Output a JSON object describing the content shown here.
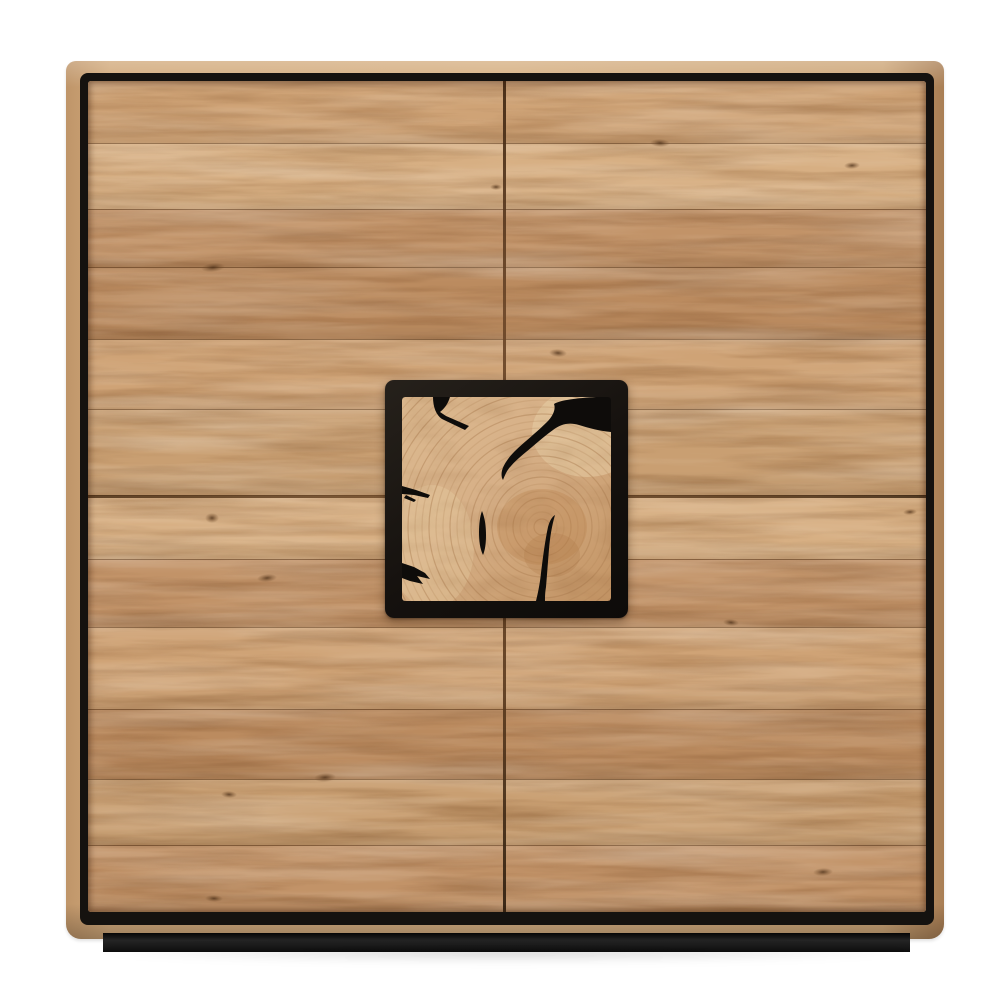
{
  "scene": {
    "type": "product-photo",
    "subject": "oak-highboard-cabinet",
    "description": "Front view of a square solid-oak cabinet with four flush plank doors, a recessed black trim frame around the door field, a recessed black plinth base, and a central black-framed end-grain oak inlay panel with black resin-filled cracks, on a plain white background.",
    "background_color": "#ffffff"
  },
  "colors": {
    "background": "#ffffff",
    "trim-black": "#15120f",
    "plinth-black": "#181818",
    "panel-frame": "#17130f",
    "crack-black": "#0e0c0a",
    "ring-stroke": "#ad7f51",
    "wood-edge-light": "#d6b083",
    "wood-edge-dark": "#a97e54",
    "plank-t1": "#cfa376",
    "plank-t2": "#c29368",
    "plank-t3": "#d7af83",
    "plank-t4": "#bb8b5f",
    "plank-t5": "#c99f72",
    "plank-seam": "#5e3c1e",
    "knot-brown": "#5f4124",
    "endgrain-light": "#e5cba1",
    "endgrain-base": "#d7b087",
    "endgrain-dark": "#c08e5c"
  },
  "cabinet": {
    "doors": {
      "rows": 2,
      "cols": 2,
      "handles": "none"
    },
    "planks": [
      {
        "height": 62,
        "tone": "plank-t1"
      },
      {
        "height": 66,
        "tone": "plank-t3"
      },
      {
        "height": 58,
        "tone": "plank-t2"
      },
      {
        "height": 72,
        "tone": "plank-t4"
      },
      {
        "height": 70,
        "tone": "plank-t1"
      },
      {
        "height": 86,
        "tone": "plank-t5"
      },
      {
        "height": 64,
        "tone": "plank-t3"
      },
      {
        "height": 68,
        "tone": "plank-t2"
      },
      {
        "height": 82,
        "tone": "plank-t1"
      },
      {
        "height": 70,
        "tone": "plank-t4"
      },
      {
        "height": 66,
        "tone": "plank-t5"
      },
      {
        "height": 67,
        "tone": "plank-t2"
      }
    ],
    "knots": [
      {
        "x": 125,
        "y": 186,
        "w": 24,
        "h": 9,
        "r": -6
      },
      {
        "x": 470,
        "y": 272,
        "w": 18,
        "h": 8,
        "r": 4
      },
      {
        "x": 764,
        "y": 84,
        "w": 16,
        "h": 7,
        "r": -3
      },
      {
        "x": 572,
        "y": 62,
        "w": 20,
        "h": 8,
        "r": 2
      },
      {
        "x": 408,
        "y": 106,
        "w": 12,
        "h": 6,
        "r": 0
      },
      {
        "x": 124,
        "y": 437,
        "w": 14,
        "h": 10,
        "r": 0
      },
      {
        "x": 179,
        "y": 497,
        "w": 20,
        "h": 8,
        "r": -5
      },
      {
        "x": 141,
        "y": 713,
        "w": 16,
        "h": 7,
        "r": 3
      },
      {
        "x": 237,
        "y": 696,
        "w": 22,
        "h": 9,
        "r": -4
      },
      {
        "x": 126,
        "y": 817,
        "w": 18,
        "h": 7,
        "r": 2
      },
      {
        "x": 735,
        "y": 791,
        "w": 20,
        "h": 8,
        "r": -3
      },
      {
        "x": 643,
        "y": 541,
        "w": 16,
        "h": 7,
        "r": 5
      },
      {
        "x": 822,
        "y": 431,
        "w": 14,
        "h": 6,
        "r": -4
      }
    ],
    "center_panel": {
      "rings": {
        "cx": 140,
        "cy": 130,
        "r0": 8,
        "gap": 7,
        "count": 30,
        "width": 1.2
      },
      "cracks": [
        {
          "name": "crack-top-left",
          "path": "M31,0 L48,0 C46,7 42,12 38,15 L44,19 L67,29 L63,33 L40,22 C34,18 31,10 31,0 Z"
        },
        {
          "name": "crack-top-right-sweep",
          "path": "M194,0 L209,0 L209,35 C197,34 187,31 177,28 C167,25 159,27 151,33 C144,38 137,44 130,50 C123,56 115,62 109,69 C105,73 103,78 101,83 C98,78 100,71 104,65 C109,57 117,50 124,44 C131,38 139,31 145,25 C151,19 154,12 152,7 C158,3 176,1 194,0 Z"
        },
        {
          "name": "crack-left-mid",
          "path": "M0,89 L14,93 L28,98 L26,101 L12,98 L0,97 Z M4,98 L14,103 L12,105 L2,101 Z"
        },
        {
          "name": "crack-center-sliver",
          "path": "M80,114 C83,121 84,130 84,138 C84,147 83,153 81,158 C78,152 77,144 77,135 C77,127 78,119 80,114 Z"
        },
        {
          "name": "crack-bottom-left",
          "path": "M0,166 L12,170 L23,176 L28,182 L15,179 L21,187 L8,184 L0,181 Z"
        },
        {
          "name": "crack-vertical-bottom",
          "path": "M153,118 C150,128 148,140 147,152 C146,164 145,178 144,190 C143,196 143,200 143,204 L134,204 C136,196 138,186 139,176 C141,160 143,144 146,130 C148,123 150,120 153,118 Z"
        }
      ]
    }
  }
}
